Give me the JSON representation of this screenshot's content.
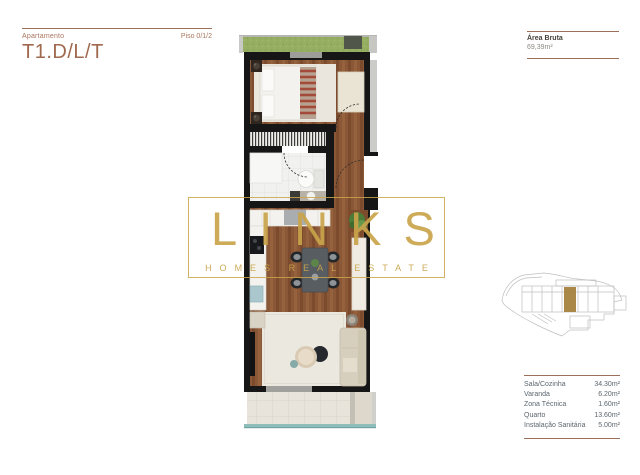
{
  "header": {
    "label": "Apartamento",
    "title": "T1.D/L/T",
    "floor": "Piso 0/1/2"
  },
  "area_info": {
    "label": "Área Bruta",
    "value": "69,39m²"
  },
  "watermark": {
    "brand": "LINKS",
    "tagline": "HOMES REAL ESTATE"
  },
  "areas_table": {
    "rows": [
      {
        "label": "Sala/Cozinha",
        "value": "34.30m²"
      },
      {
        "label": "Varanda",
        "value": "6.20m²"
      },
      {
        "label": "Zona Técnica",
        "value": "1.60m²"
      },
      {
        "label": "Quarto",
        "value": "13.60m²"
      },
      {
        "label": "Instalação Sanitária",
        "value": "5.00m²"
      }
    ]
  },
  "colors": {
    "accent_gold": "#C9A44B",
    "heading_brown": "#A0694E",
    "rule_brown": "#9B7058",
    "table_text": "#5B666E",
    "wall_black": "#161616",
    "wood_floor": "#8A5737",
    "grass_green": "#95AE61",
    "railing_teal": "#8FBDBA",
    "highlight_unit": "#A5823D"
  }
}
